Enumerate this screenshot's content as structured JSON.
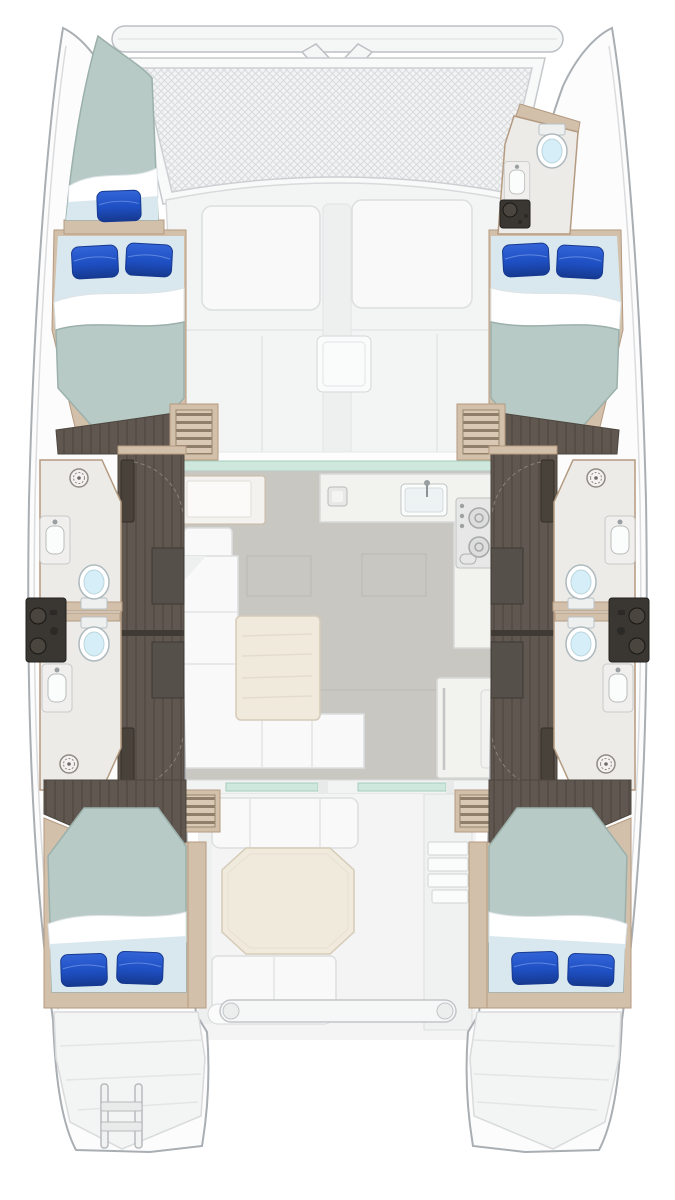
{
  "vessel": {
    "type": "sailing-catamaran",
    "view": "overhead-interior-floor-plan"
  },
  "bow": {
    "features": [
      "forward-crossbeam",
      "bowsprit-seagull-striker",
      "trampoline-net"
    ]
  },
  "foredeck": {
    "features": [
      "sunpad-port",
      "sunpad-starboard",
      "center-walkway",
      "deck-hatch"
    ]
  },
  "port_hull": {
    "forepeak": {
      "type": "single-berth",
      "pillows": 1
    },
    "forward_cabin": {
      "type": "double-berth",
      "pillows": 2
    },
    "midship": {
      "bathrooms": 2,
      "toilets": 2,
      "sinks": 2,
      "shower_drains": 2,
      "equipment_panels": 1,
      "doors": 2
    },
    "aft_cabin": {
      "type": "double-berth",
      "pillows": 2
    },
    "transom": {
      "features": [
        "swim-steps",
        "boarding-ladder"
      ]
    }
  },
  "starboard_hull": {
    "forepeak": {
      "type": "head-compartment",
      "toilets": 1,
      "sinks": 1,
      "equipment_panels": 1
    },
    "forward_cabin": {
      "type": "double-berth",
      "pillows": 2
    },
    "midship": {
      "bathrooms": 2,
      "toilets": 2,
      "sinks": 2,
      "shower_drains": 2,
      "equipment_panels": 1,
      "doors": 2
    },
    "aft_cabin": {
      "type": "double-berth",
      "pillows": 2
    },
    "transom": {
      "features": [
        "swim-steps"
      ]
    }
  },
  "saloon": {
    "features": [
      "windshield-glass",
      "nav-station-seat",
      "l-shaped-sofa",
      "dining-table",
      "galley-counter",
      "galley-sink",
      "stove-two-burner",
      "counter-hatch",
      "refrigerator",
      "companionway-steps-port",
      "companionway-steps-starboard",
      "aft-sliding-door-glass"
    ]
  },
  "cockpit": {
    "features": [
      "forward-bench",
      "octagonal-table",
      "aft-bench-with-armrest",
      "helm-access-steps",
      "hull-entry-steps-port",
      "hull-entry-steps-starboard",
      "dinghy-davit-bar"
    ]
  },
  "totals": {
    "double_cabins": 4,
    "single_berths": 1,
    "toilets": 5,
    "blue_pillows": 9
  },
  "colors": {
    "hull_outline": "#a9aeb3",
    "deck_white": "#f3f4f4",
    "cushion_white": "#f8f9f8",
    "trampoline_base": "#f2f3f4",
    "trampoline_grid": "#d8dadb",
    "glass_teal": "#cfe8de",
    "saloon_floor": "#c9c7c2",
    "counter_white": "#f2f2ef",
    "table_cream": "#f0eadd",
    "wood_tan": "#d3c0aa",
    "wood_tan_dark": "#b49a80",
    "teak_dark": "#5f5750",
    "plank_line": "#514a42",
    "door_dark": "#49423a",
    "mattress_teal": "#b7cac5",
    "sheet_blue": "#d9e8ef",
    "pillow_blue": "#1e4fc2",
    "pillow_deep": "#16398f",
    "toilet_bowl": "#d6eef7",
    "panel_black": "#3a3733",
    "stove_gray": "#e6e7e6",
    "stripe_light": "#d9c8b3",
    "stripe_dark": "#8f7f6a"
  }
}
